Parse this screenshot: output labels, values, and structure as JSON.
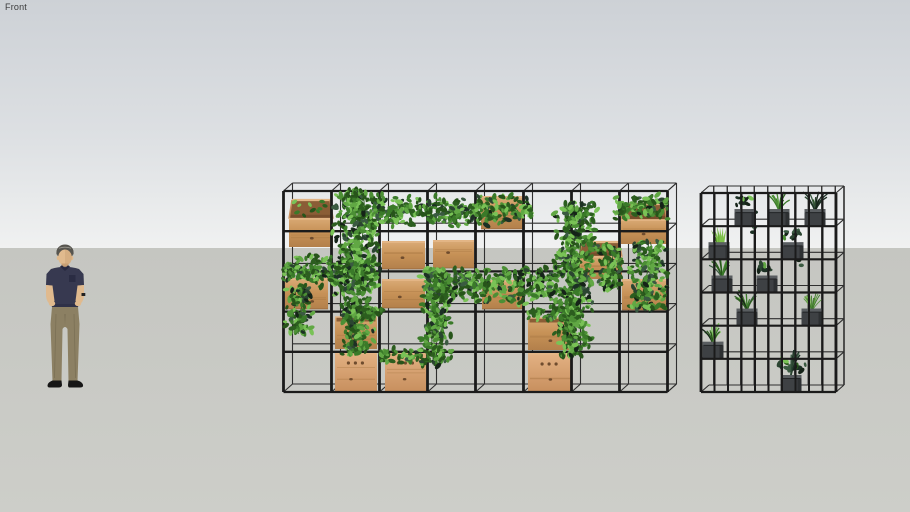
{
  "viewport": {
    "scene_label": "Front",
    "width": 910,
    "height": 512,
    "horizon_y": 248,
    "label_color": "#3b3b3b",
    "sky_top": "#cdd1d6",
    "sky_mid": "#dde0e3",
    "sky_bottom": "#f0f1f1",
    "ground_top": "#c5c6c1",
    "ground_bottom": "#cdcec9"
  },
  "palette": {
    "frame": "#1b1b1b",
    "frame_back": "#2f2f2f",
    "wood_face_top": "#d8a873",
    "wood_face_mid": "#c79257",
    "wood_face_bot": "#b3804b",
    "wood_light_top": "#e2b081",
    "wood_light_bot": "#c8905f",
    "wood_rim": "#e3b585",
    "wood_inner": "#8a5d36",
    "wood_inner_deep": "#6d4527",
    "wood_knot": "#6f4c2e",
    "wood_streak": "#a3733f",
    "greens": [
      "#61a844",
      "#4c8f35",
      "#3a7a29",
      "#2c5e1f",
      "#79c256",
      "#27541a"
    ],
    "dark_greens": [
      "#2b4531",
      "#1c3024",
      "#3a5a41",
      "#152318"
    ],
    "stem": "#2e5e20",
    "pot_body": "#3e4144",
    "pot_rim": "#595d60",
    "pot_side": "#2d3032",
    "aloe": [
      "#6fb33c",
      "#529627",
      "#7fc24a"
    ],
    "grass": [
      "#7fb356",
      "#5a9440",
      "#3f7a2c"
    ]
  },
  "person": {
    "x": 41,
    "y": 244,
    "width": 48,
    "height": 144,
    "skin": "#e0ba8e",
    "skin_shade": "#c79f74",
    "hair": "#57554f",
    "hair_light": "#9b9890",
    "shirt": "#373950",
    "shirt_shade": "#272940",
    "pants": "#8c8063",
    "pants_shade": "#6f654c",
    "shoes": "#161616",
    "watch": "#222222"
  },
  "left_unit": {
    "x": 283.5,
    "y": 191,
    "w": 384,
    "h": 201,
    "cols": 8,
    "rows": 5,
    "depth_dx": 9,
    "depth_dy": -8,
    "boxes": [
      {
        "x": 289,
        "y": 200,
        "w": 44,
        "h": 47,
        "type": "open"
      },
      {
        "x": 481,
        "y": 198,
        "w": 44,
        "h": 31,
        "type": "plain"
      },
      {
        "x": 621,
        "y": 204,
        "w": 46,
        "h": 40,
        "type": "open"
      },
      {
        "x": 382,
        "y": 243,
        "w": 43,
        "h": 26,
        "type": "plain"
      },
      {
        "x": 433,
        "y": 242,
        "w": 41,
        "h": 26,
        "type": "plain"
      },
      {
        "x": 579,
        "y": 242,
        "w": 43,
        "h": 37,
        "type": "open"
      },
      {
        "x": 285,
        "y": 280,
        "w": 43,
        "h": 29,
        "type": "plain"
      },
      {
        "x": 382,
        "y": 281,
        "w": 43,
        "h": 27,
        "type": "plain"
      },
      {
        "x": 482,
        "y": 282,
        "w": 42,
        "h": 27,
        "type": "plain"
      },
      {
        "x": 622,
        "y": 281,
        "w": 44,
        "h": 29,
        "type": "plain"
      },
      {
        "x": 335,
        "y": 317,
        "w": 42,
        "h": 32,
        "type": "openlow"
      },
      {
        "x": 528,
        "y": 318,
        "w": 43,
        "h": 32,
        "type": "openlow"
      },
      {
        "x": 335,
        "y": 354,
        "w": 42,
        "h": 37,
        "type": "holes"
      },
      {
        "x": 385,
        "y": 354,
        "w": 42,
        "h": 37,
        "type": "holes"
      },
      {
        "x": 528,
        "y": 355,
        "w": 44,
        "h": 36,
        "type": "holes"
      }
    ],
    "ivy": [
      {
        "x": 330,
        "y": 190,
        "w": 52,
        "h": 105,
        "dir": "v"
      },
      {
        "x": 374,
        "y": 194,
        "w": 158,
        "h": 34,
        "dir": "h"
      },
      {
        "x": 552,
        "y": 202,
        "w": 46,
        "h": 100,
        "dir": "v"
      },
      {
        "x": 614,
        "y": 194,
        "w": 54,
        "h": 28,
        "dir": "h"
      },
      {
        "x": 283,
        "y": 252,
        "w": 96,
        "h": 38,
        "dir": "h"
      },
      {
        "x": 425,
        "y": 266,
        "w": 132,
        "h": 40,
        "dir": "h"
      },
      {
        "x": 420,
        "y": 268,
        "w": 34,
        "h": 98,
        "dir": "v"
      },
      {
        "x": 340,
        "y": 298,
        "w": 36,
        "h": 56,
        "dir": "v"
      },
      {
        "x": 552,
        "y": 300,
        "w": 42,
        "h": 56,
        "dir": "v"
      },
      {
        "x": 628,
        "y": 242,
        "w": 40,
        "h": 68,
        "dir": "v"
      },
      {
        "x": 283,
        "y": 288,
        "w": 30,
        "h": 46,
        "dir": "v"
      },
      {
        "x": 342,
        "y": 306,
        "w": 40,
        "h": 16,
        "dir": "h"
      },
      {
        "x": 528,
        "y": 306,
        "w": 46,
        "h": 16,
        "dir": "h"
      },
      {
        "x": 380,
        "y": 348,
        "w": 42,
        "h": 16,
        "dir": "h"
      },
      {
        "x": 596,
        "y": 246,
        "w": 30,
        "h": 44,
        "dir": "v"
      }
    ]
  },
  "right_unit": {
    "x": 701,
    "y": 193,
    "w": 135,
    "h": 199,
    "bars": 11,
    "rows": 6,
    "depth_dx": 8,
    "depth_dy": -7,
    "pots": [
      {
        "cx": 745,
        "shelf": 1,
        "plant": "darktrail"
      },
      {
        "cx": 779,
        "shelf": 1,
        "plant": "fern"
      },
      {
        "cx": 815,
        "shelf": 1,
        "plant": "darkfern"
      },
      {
        "cx": 719,
        "shelf": 2,
        "plant": "aloe"
      },
      {
        "cx": 793,
        "shelf": 2,
        "plant": "darktrail"
      },
      {
        "cx": 722,
        "shelf": 3,
        "plant": "fern"
      },
      {
        "cx": 767,
        "shelf": 3,
        "plant": "darkplant"
      },
      {
        "cx": 747,
        "shelf": 4,
        "plant": "fern"
      },
      {
        "cx": 812,
        "shelf": 4,
        "plant": "grass"
      },
      {
        "cx": 713,
        "shelf": 5,
        "plant": "fern"
      },
      {
        "cx": 791,
        "shelf": 6,
        "plant": "bigdark"
      }
    ]
  }
}
